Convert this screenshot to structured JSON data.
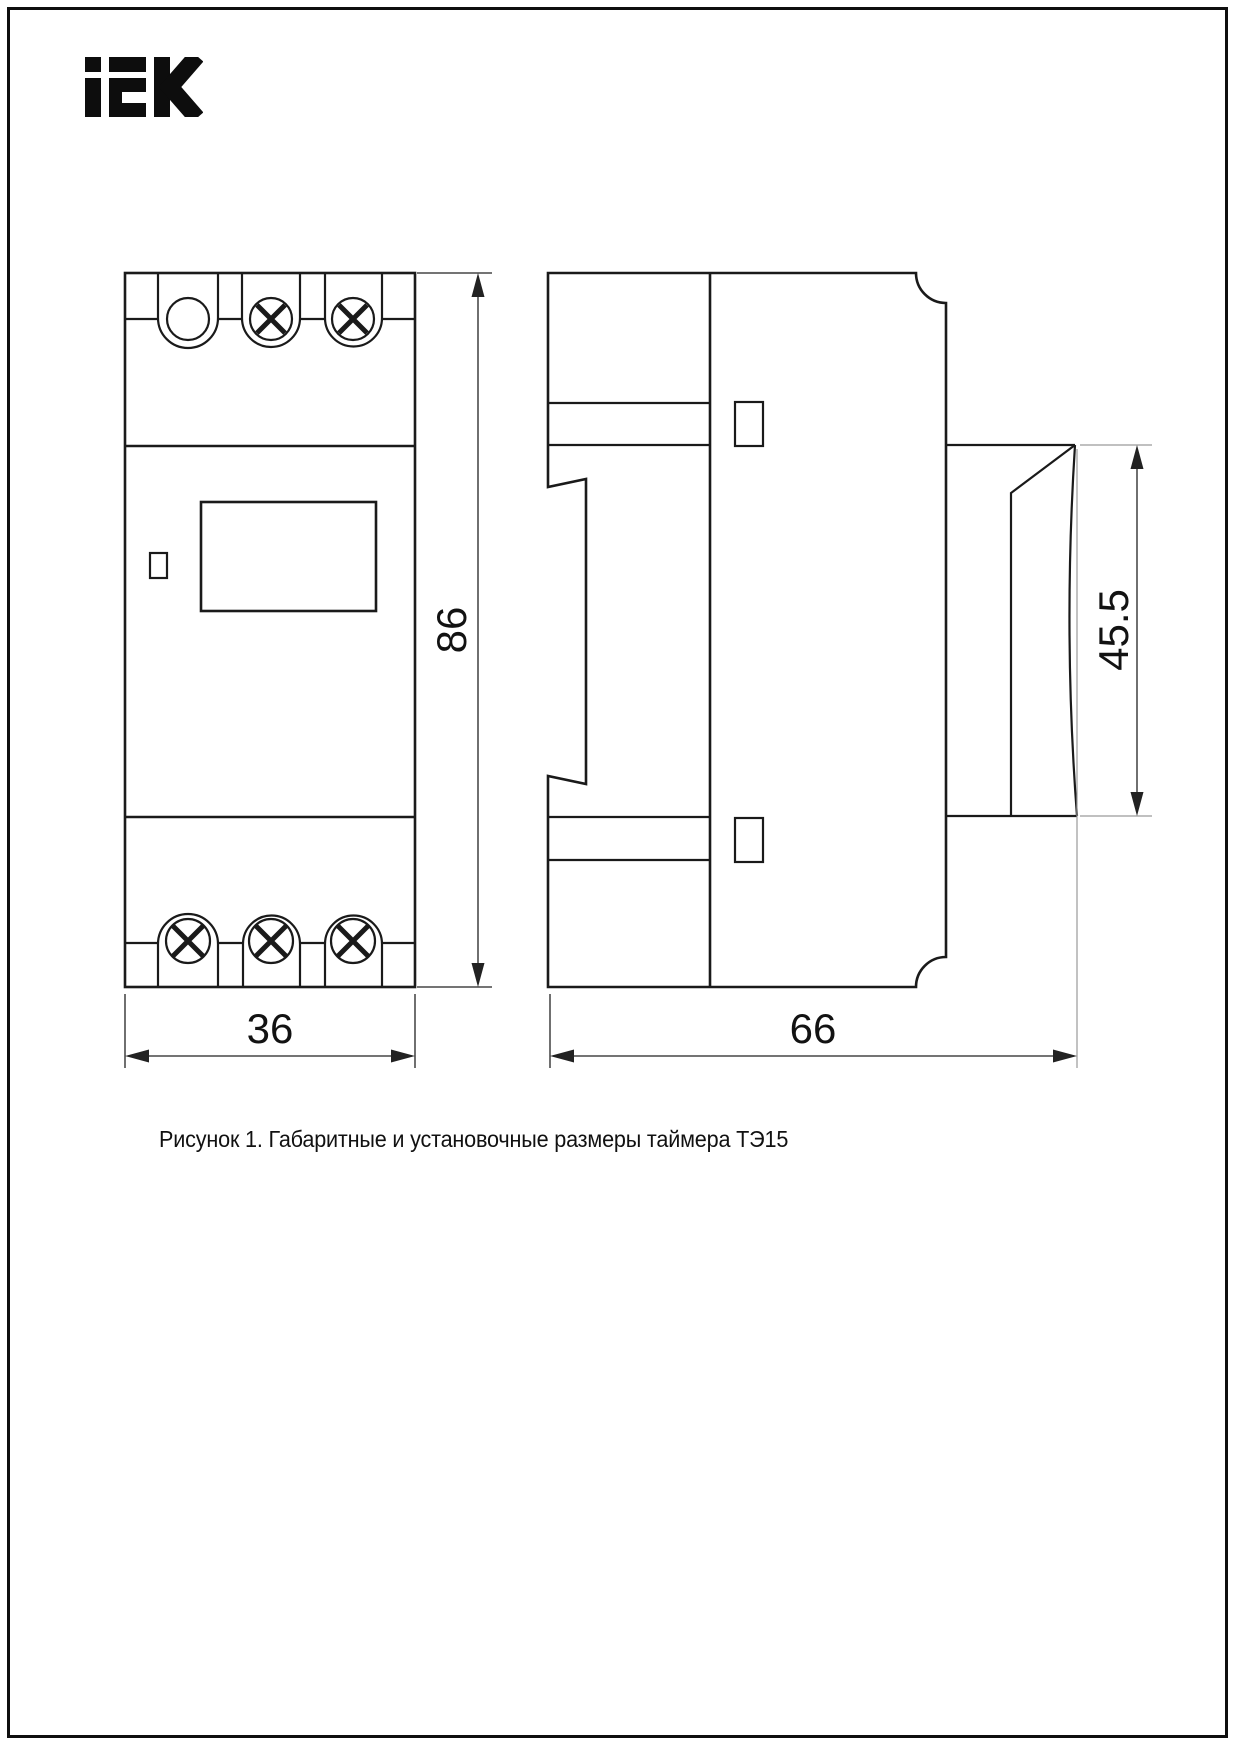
{
  "page": {
    "background": "#ffffff",
    "border_color": "#0f0f0f"
  },
  "brand": {
    "logo_text": "iEK"
  },
  "drawing": {
    "caption": "Рисунок 1. Габаритные и установочные размеры таймера ТЭ15",
    "line_color": "#1a1a1a",
    "extension_line_color": "#9a9a9a",
    "views": {
      "front": {
        "width_mm": "36",
        "height_mm": "86"
      },
      "side": {
        "depth_mm": "66",
        "front_panel_height_mm": "45.5"
      }
    }
  }
}
